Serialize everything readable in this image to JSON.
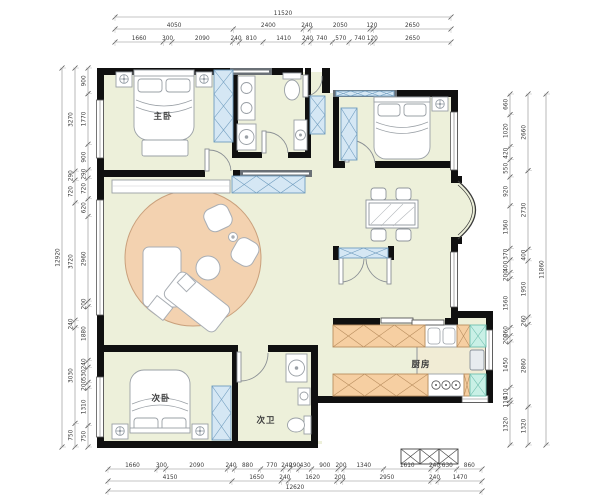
{
  "plan": {
    "rooms": [
      {
        "id": "master-bedroom",
        "label": "主卧"
      },
      {
        "id": "second-bedroom",
        "label": "次卧"
      },
      {
        "id": "second-bathroom",
        "label": "次卫"
      },
      {
        "id": "kitchen",
        "label": "厨房"
      }
    ]
  },
  "dimensions": {
    "top": {
      "rows": [
        {
          "values": [
            11520
          ]
        },
        {
          "values": [
            4050,
            2400,
            240,
            2050,
            120,
            2650
          ]
        },
        {
          "values": [
            1660,
            300,
            2090,
            240,
            810,
            1410,
            240,
            740,
            570,
            740,
            120,
            2650
          ]
        }
      ]
    },
    "bottom": {
      "rows": [
        {
          "values": [
            1660,
            300,
            2090,
            240,
            880,
            770,
            240,
            290,
            430,
            900,
            200,
            1340,
            1610,
            240,
            630,
            860
          ]
        },
        {
          "values": [
            4150,
            1650,
            240,
            1620,
            200,
            2950,
            240,
            1470
          ]
        },
        {
          "values": [
            12620
          ]
        }
      ]
    },
    "left": {
      "rows": [
        {
          "values": [
            12920
          ]
        },
        {
          "values": [
            3270,
            290,
            720,
            3720,
            240,
            3030,
            750
          ]
        },
        {
          "values": [
            900,
            1770,
            900,
            290,
            720,
            620,
            2960,
            200,
            1880,
            240,
            530,
            200,
            1310,
            750
          ]
        }
      ]
    },
    "right": {
      "rows": [
        {
          "values": [
            660,
            1020,
            420,
            550,
            920,
            1360,
            370,
            400,
            200,
            1560,
            260,
            200,
            1450,
            410,
            110,
            1320
          ]
        },
        {
          "values": [
            2660,
            2730,
            400,
            1950,
            260,
            2860,
            1320
          ]
        },
        {
          "values": [
            11860
          ]
        }
      ]
    }
  },
  "colors": {
    "wall": "#101010",
    "gray_wall": "#6a7076",
    "floor": "#edf0da",
    "rug": "#f3d2b0",
    "rug_stroke": "#c9a07c",
    "wardrobe": "#d5e7f4",
    "wardrobe_stroke": "#6f9cbe",
    "counter": "#f6cfa2",
    "counter_stroke": "#b98e5f",
    "balcony": "#c9f0e6",
    "balcony_stroke": "#6fbfae",
    "furniture_stroke": "#9aa0a6",
    "dim_line": "#8a8a8a",
    "dim_text": "#3a3a3a"
  }
}
